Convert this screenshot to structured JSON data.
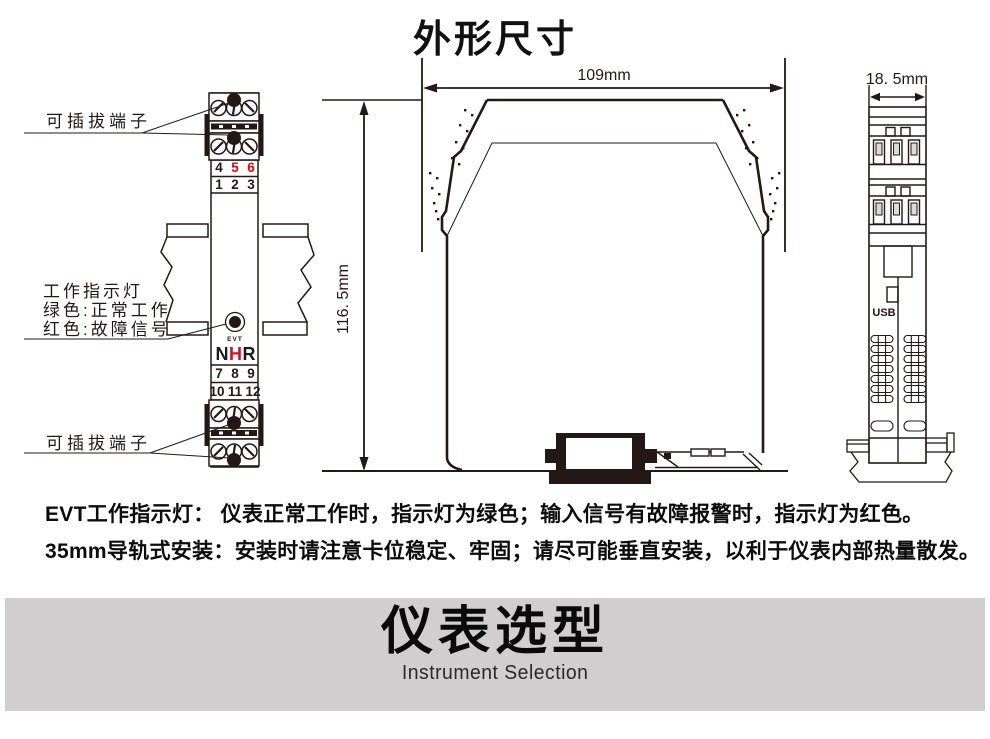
{
  "title": "外形尺寸",
  "colors": {
    "ink": "#231815",
    "red": "#e60012",
    "banner_bg": "#d0cecf",
    "logo_red": "#cf1126"
  },
  "front_view": {
    "pluggable_label_top": "可插拔端子",
    "pluggable_label_bottom": "可插拔端子",
    "indicator_label": [
      "工作指示灯",
      "绿色:正常工作",
      "红色:故障信号"
    ],
    "terminal_numbers": {
      "row1": [
        "4",
        "5",
        "6"
      ],
      "row2": [
        "1",
        "2",
        "3"
      ],
      "row3": [
        "7",
        "8",
        "9"
      ],
      "row4": [
        "10",
        "11",
        "12"
      ]
    },
    "evt_label": "EVT",
    "logo_letters": [
      "N",
      "H",
      "R"
    ]
  },
  "side_view": {
    "width_label": "109mm",
    "height_label": "116. 5mm"
  },
  "end_view": {
    "width_label": "18. 5mm",
    "usb_label": "USB"
  },
  "notes": [
    "EVT工作指示灯： 仪表正常工作时，指示灯为绿色；输入信号有故障报警时，指示灯为红色。",
    "35mm导轨式安装：安装时请注意卡位稳定、牢固；请尽可能垂直安装，以利于仪表内部热量散发。"
  ],
  "banner": {
    "title": "仪表选型",
    "subtitle": "Instrument Selection"
  }
}
